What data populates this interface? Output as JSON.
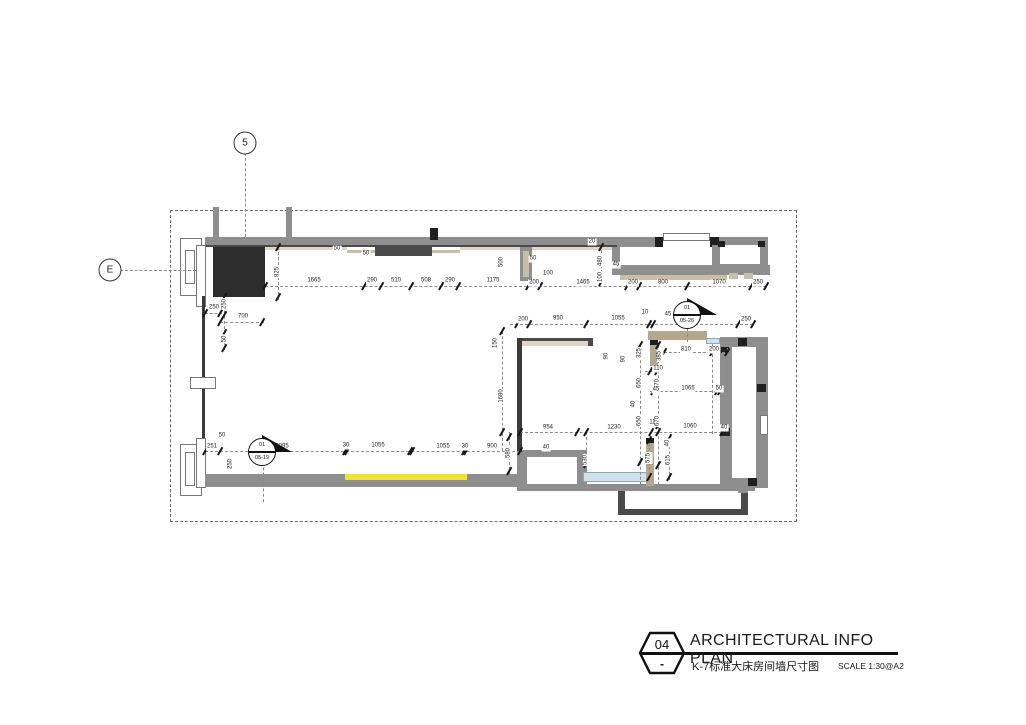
{
  "title_block": {
    "number": "04",
    "dash": "-",
    "title": "ARCHITECTURAL INFO PLAN",
    "subtitle": "K-7标准大床房间墙尺寸图",
    "scale": "SCALE 1:30@A2"
  },
  "grid_markers": [
    {
      "label": "5",
      "cx": 245,
      "cy": 143
    },
    {
      "label": "E",
      "cx": 110,
      "cy": 270
    }
  ],
  "section_markers": [
    {
      "top": "01",
      "bottom": "05-19",
      "cx": 262,
      "cy": 452
    },
    {
      "top": "01",
      "bottom": "05-26",
      "cx": 687,
      "cy": 315
    }
  ],
  "colors": {
    "wall_gray": "#8e8e8e",
    "wall_dark": "#4a4a4a",
    "near_black": "#1f1f1f",
    "column": "#2d2d2d",
    "beige": "#c8bda6",
    "beige_light": "#ddd6c8",
    "tan": "#b3a78e",
    "accent_yellow": "#f0e13c",
    "glass_blue": "#cfe2ed",
    "dark_line": "#3a3a3a",
    "white": "#ffffff"
  },
  "plan": {
    "boundary": {
      "x": 170,
      "y": 210,
      "w": 625,
      "h": 310
    },
    "walls": [
      [
        205,
        237,
        412,
        10,
        "g"
      ],
      [
        205,
        245,
        412,
        2,
        "d"
      ],
      [
        617,
        237,
        38,
        10,
        "g"
      ],
      [
        655,
        237,
        8,
        10,
        "k"
      ],
      [
        663,
        233,
        47,
        8,
        "wf"
      ],
      [
        710,
        237,
        9,
        10,
        "k"
      ],
      [
        719,
        237,
        49,
        8,
        "g"
      ],
      [
        760,
        245,
        8,
        27,
        "g"
      ],
      [
        712,
        245,
        8,
        27,
        "g"
      ],
      [
        712,
        264,
        56,
        8,
        "g"
      ],
      [
        718,
        241,
        7,
        6,
        "k"
      ],
      [
        758,
        241,
        7,
        6,
        "k"
      ],
      [
        612,
        247,
        8,
        28,
        "g"
      ],
      [
        617,
        265,
        153,
        10,
        "g"
      ],
      [
        620,
        275,
        107,
        5,
        "b"
      ],
      [
        729,
        273,
        9,
        6,
        "b"
      ],
      [
        744,
        273,
        9,
        6,
        "b"
      ],
      [
        213,
        207,
        6,
        30,
        "g"
      ],
      [
        286,
        207,
        6,
        30,
        "g"
      ],
      [
        430,
        228,
        8,
        12,
        "k"
      ],
      [
        265,
        247,
        82,
        3,
        "b2"
      ],
      [
        460,
        247,
        60,
        3,
        "b2"
      ],
      [
        532,
        247,
        80,
        3,
        "b2"
      ],
      [
        347,
        250,
        28,
        3,
        "b"
      ],
      [
        432,
        250,
        28,
        3,
        "b"
      ],
      [
        375,
        247,
        57,
        9,
        "d"
      ],
      [
        213,
        247,
        52,
        50,
        "col"
      ],
      [
        520,
        247,
        12,
        34,
        "g"
      ],
      [
        523,
        251,
        6,
        26,
        "b"
      ],
      [
        180,
        238,
        22,
        58,
        "wf"
      ],
      [
        185,
        250,
        10,
        34,
        "wf"
      ],
      [
        196,
        245,
        10,
        62,
        "wf"
      ],
      [
        202,
        296,
        3,
        180,
        "dl"
      ],
      [
        190,
        377,
        26,
        12,
        "wf"
      ],
      [
        180,
        444,
        22,
        52,
        "wf"
      ],
      [
        185,
        452,
        10,
        34,
        "wf"
      ],
      [
        196,
        438,
        10,
        50,
        "wf"
      ],
      [
        205,
        474,
        145,
        13,
        "g"
      ],
      [
        345,
        474,
        122,
        6,
        "y"
      ],
      [
        345,
        480,
        122,
        7,
        "g"
      ],
      [
        467,
        474,
        53,
        13,
        "g"
      ],
      [
        517,
        450,
        70,
        7,
        "g"
      ],
      [
        517,
        450,
        10,
        36,
        "g"
      ],
      [
        577,
        450,
        10,
        36,
        "g"
      ],
      [
        583,
        472,
        66,
        10,
        "gl"
      ],
      [
        517,
        484,
        238,
        7,
        "g"
      ],
      [
        618,
        491,
        7,
        23,
        "d"
      ],
      [
        618,
        509,
        130,
        6,
        "d"
      ],
      [
        741,
        491,
        7,
        23,
        "d"
      ],
      [
        517,
        338,
        5,
        114,
        "dl"
      ],
      [
        522,
        338,
        71,
        3,
        "d"
      ],
      [
        522,
        341,
        71,
        5,
        "b2"
      ],
      [
        588,
        338,
        5,
        8,
        "d"
      ],
      [
        648,
        331,
        59,
        9,
        "t"
      ],
      [
        706,
        338,
        14,
        6,
        "gl"
      ],
      [
        650,
        340,
        8,
        26,
        "t"
      ],
      [
        650,
        340,
        8,
        5,
        "k"
      ],
      [
        646,
        438,
        8,
        48,
        "t"
      ],
      [
        646,
        438,
        8,
        5,
        "k"
      ],
      [
        720,
        337,
        48,
        10,
        "g"
      ],
      [
        720,
        347,
        12,
        131,
        "g"
      ],
      [
        756,
        340,
        12,
        143,
        "g"
      ],
      [
        720,
        478,
        48,
        10,
        "g"
      ],
      [
        760,
        415,
        8,
        20,
        "wf"
      ],
      [
        738,
        338,
        9,
        8,
        "k"
      ],
      [
        757,
        384,
        9,
        8,
        "k"
      ],
      [
        721,
        428,
        9,
        8,
        "k"
      ],
      [
        748,
        478,
        9,
        8,
        "k"
      ],
      [
        721,
        347,
        8,
        6,
        "k"
      ],
      [
        738,
        488,
        10,
        5,
        "g"
      ]
    ],
    "dashes": [
      [
        245,
        153,
        245,
        237
      ],
      [
        120,
        270,
        196,
        270
      ],
      [
        265,
        286,
        766,
        286
      ],
      [
        510,
        324,
        753,
        324
      ],
      [
        205,
        451,
        520,
        451
      ],
      [
        520,
        432,
        722,
        432
      ],
      [
        502,
        331,
        502,
        451
      ],
      [
        640,
        345,
        640,
        490
      ],
      [
        658,
        345,
        658,
        490
      ],
      [
        278,
        247,
        278,
        300
      ],
      [
        224,
        295,
        224,
        350
      ],
      [
        509,
        432,
        509,
        475
      ],
      [
        586,
        432,
        586,
        466
      ],
      [
        649,
        438,
        649,
        480
      ],
      [
        669,
        436,
        669,
        480
      ],
      [
        601,
        245,
        601,
        283
      ],
      [
        664,
        352,
        730,
        352
      ],
      [
        650,
        391,
        727,
        391
      ],
      [
        645,
        371,
        660,
        371
      ],
      [
        712,
        344,
        712,
        434
      ],
      [
        727,
        348,
        727,
        394
      ],
      [
        263,
        462,
        263,
        502
      ],
      [
        687,
        328,
        687,
        342
      ],
      [
        205,
        313,
        222,
        313
      ],
      [
        220,
        322,
        264,
        322
      ]
    ],
    "ticks": [
      [
        265,
        286
      ],
      [
        364,
        286
      ],
      [
        381,
        286
      ],
      [
        411,
        286
      ],
      [
        441,
        286
      ],
      [
        458,
        286
      ],
      [
        528,
        286
      ],
      [
        540,
        286
      ],
      [
        627,
        286
      ],
      [
        639,
        286
      ],
      [
        687,
        286
      ],
      [
        751,
        286
      ],
      [
        766,
        286
      ],
      [
        517,
        324
      ],
      [
        529,
        324
      ],
      [
        586,
        324
      ],
      [
        649,
        324
      ],
      [
        653,
        324
      ],
      [
        738,
        324
      ],
      [
        753,
        324
      ],
      [
        205,
        451
      ],
      [
        220,
        451
      ],
      [
        345,
        451
      ],
      [
        347,
        451
      ],
      [
        410,
        451
      ],
      [
        412,
        451
      ],
      [
        464,
        451
      ],
      [
        466,
        451
      ],
      [
        520,
        451
      ],
      [
        520,
        432
      ],
      [
        577,
        432
      ],
      [
        651,
        432
      ],
      [
        658,
        432
      ],
      [
        722,
        432
      ],
      [
        640,
        345
      ],
      [
        640,
        384
      ],
      [
        640,
        423
      ],
      [
        640,
        462
      ],
      [
        658,
        345
      ],
      [
        658,
        385
      ],
      [
        658,
        425
      ],
      [
        658,
        465
      ],
      [
        502,
        331
      ],
      [
        502,
        432
      ],
      [
        278,
        247
      ],
      [
        278,
        297
      ],
      [
        224,
        297
      ],
      [
        224,
        315
      ],
      [
        224,
        333
      ],
      [
        224,
        348
      ],
      [
        509,
        437
      ],
      [
        509,
        471
      ],
      [
        586,
        432
      ],
      [
        586,
        464
      ],
      [
        649,
        440
      ],
      [
        649,
        477
      ],
      [
        669,
        438
      ],
      [
        669,
        477
      ],
      [
        601,
        247
      ],
      [
        601,
        276
      ],
      [
        601,
        282
      ],
      [
        205,
        313
      ],
      [
        220,
        313
      ],
      [
        220,
        322
      ],
      [
        262,
        322
      ],
      [
        664,
        352
      ],
      [
        712,
        352
      ],
      [
        727,
        352
      ],
      [
        653,
        391
      ],
      [
        717,
        391
      ],
      [
        720,
        391
      ],
      [
        650,
        371
      ],
      [
        657,
        371
      ]
    ],
    "dims": [
      [
        314,
        281,
        "1665"
      ],
      [
        372,
        281,
        "290"
      ],
      [
        396,
        281,
        "510"
      ],
      [
        426,
        281,
        "508"
      ],
      [
        450,
        281,
        "290"
      ],
      [
        493,
        281,
        "1175"
      ],
      [
        534,
        283,
        "200"
      ],
      [
        583,
        283,
        "1465"
      ],
      [
        633,
        283,
        "200"
      ],
      [
        663,
        283,
        "800"
      ],
      [
        719,
        283,
        "1070"
      ],
      [
        758,
        283,
        "250"
      ],
      [
        523,
        320,
        "200"
      ],
      [
        558,
        319,
        "950"
      ],
      [
        618,
        319,
        "1055"
      ],
      [
        645,
        313,
        "10"
      ],
      [
        668,
        315,
        "45"
      ],
      [
        694,
        320,
        "1425"
      ],
      [
        746,
        320,
        "250"
      ],
      [
        212,
        447,
        "251"
      ],
      [
        282,
        447,
        "2095"
      ],
      [
        346,
        446,
        "30"
      ],
      [
        378,
        446,
        "1055"
      ],
      [
        443,
        447,
        "1055"
      ],
      [
        465,
        447,
        "30"
      ],
      [
        492,
        447,
        "900"
      ],
      [
        222,
        436,
        "50"
      ],
      [
        231,
        464,
        "250",
        1
      ],
      [
        548,
        428,
        "954"
      ],
      [
        614,
        428,
        "1230"
      ],
      [
        654,
        423,
        "110"
      ],
      [
        690,
        427,
        "1060"
      ],
      [
        278,
        272,
        "825",
        1
      ],
      [
        214,
        308,
        "250"
      ],
      [
        225,
        304,
        "250",
        1
      ],
      [
        243,
        317,
        "700"
      ],
      [
        225,
        339,
        "50",
        1
      ],
      [
        502,
        262,
        "500",
        1
      ],
      [
        533,
        259,
        "50"
      ],
      [
        548,
        274,
        "100"
      ],
      [
        592,
        242,
        "20"
      ],
      [
        601,
        261,
        "480",
        1
      ],
      [
        601,
        277,
        "100",
        1
      ],
      [
        616,
        265,
        "45"
      ],
      [
        496,
        343,
        "150",
        1
      ],
      [
        502,
        396,
        "1680",
        1
      ],
      [
        607,
        356,
        "90",
        1
      ],
      [
        624,
        359,
        "90",
        1
      ],
      [
        640,
        353,
        "325",
        1
      ],
      [
        660,
        356,
        "385",
        1
      ],
      [
        686,
        350,
        "810"
      ],
      [
        714,
        350,
        "200"
      ],
      [
        658,
        369,
        "110"
      ],
      [
        640,
        383,
        "650",
        1
      ],
      [
        658,
        384,
        "670",
        1
      ],
      [
        656,
        390,
        "45"
      ],
      [
        688,
        389,
        "1065"
      ],
      [
        719,
        389,
        "50"
      ],
      [
        634,
        404,
        "40",
        1
      ],
      [
        640,
        421,
        "650",
        1
      ],
      [
        658,
        421,
        "670",
        1
      ],
      [
        724,
        428,
        "40"
      ],
      [
        509,
        453,
        "580",
        1
      ],
      [
        546,
        448,
        "40"
      ],
      [
        586,
        460,
        "530",
        1
      ],
      [
        649,
        458,
        "575",
        1
      ],
      [
        669,
        460,
        "615",
        1
      ],
      [
        668,
        443,
        "40",
        1
      ],
      [
        337,
        249,
        "50"
      ],
      [
        366,
        254,
        "50"
      ]
    ]
  }
}
